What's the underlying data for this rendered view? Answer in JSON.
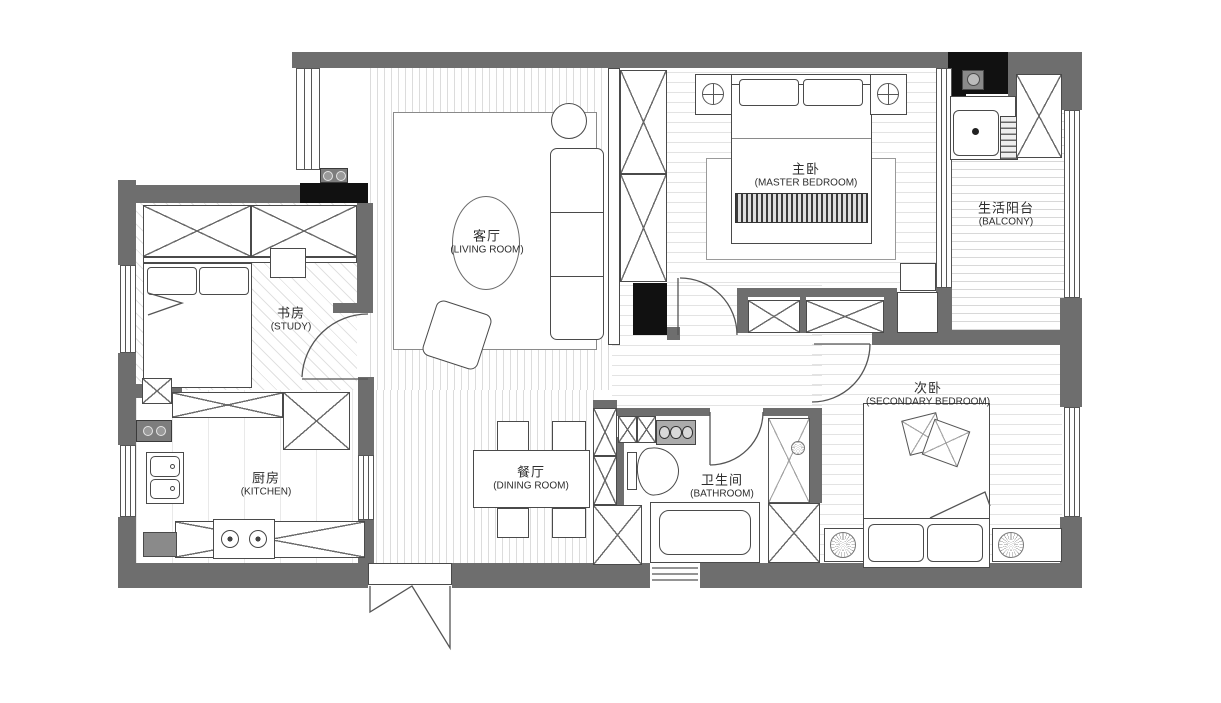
{
  "plan": {
    "rooms": [
      {
        "id": "living-room",
        "zh": "客厅",
        "en": "(LIVING ROOM)"
      },
      {
        "id": "master-bedroom",
        "zh": "主卧",
        "en": "(MASTER BEDROOM)"
      },
      {
        "id": "balcony",
        "zh": "生活阳台",
        "en": "(BALCONY)"
      },
      {
        "id": "study",
        "zh": "书房",
        "en": "(STUDY)"
      },
      {
        "id": "kitchen",
        "zh": "厨房",
        "en": "(KITCHEN)"
      },
      {
        "id": "dining-room",
        "zh": "餐厅",
        "en": "(DINING ROOM)"
      },
      {
        "id": "bathroom",
        "zh": "卫生间",
        "en": "(BATHROOM)"
      },
      {
        "id": "secondary-bedroom",
        "zh": "次卧",
        "en": "(SECONDARY BEDROOM)"
      }
    ],
    "colors": {
      "wall": "#6e6e6e",
      "structural_black": "#111111",
      "line": "#4a4a4a",
      "floor_hatch": "#dcdcdc"
    }
  }
}
